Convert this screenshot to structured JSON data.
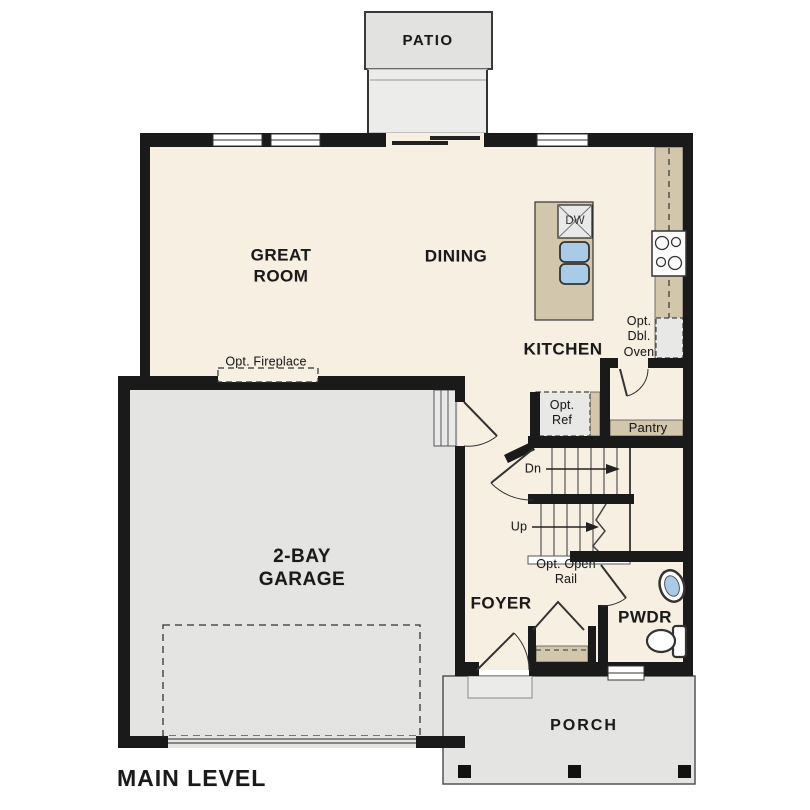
{
  "plan": {
    "title": "MAIN LEVEL",
    "rooms": {
      "patio": "PATIO",
      "great_room": "GREAT\nROOM",
      "dining": "DINING",
      "kitchen": "KITCHEN",
      "garage": "2-BAY\nGARAGE",
      "foyer": "FOYER",
      "powder": "PWDR",
      "porch": "PORCH"
    },
    "annotations": {
      "opt_fireplace": "Opt. Fireplace",
      "opt_ref": "Opt.\nRef",
      "opt_dbl_oven": "Opt.\nDbl.\nOven",
      "pantry": "Pantry",
      "stairs_down": "Dn",
      "stairs_up": "Up",
      "opt_open_rail": "Opt. Open\nRail",
      "dishwasher": "DW"
    },
    "fixtures": [
      "dishwasher",
      "kitchen-sink",
      "range",
      "double-oven-option",
      "refrigerator-option",
      "bathroom-sink",
      "toilet",
      "stairs",
      "coat-closet"
    ],
    "colors": {
      "wall": "#1a1a1a",
      "interior_floor": "#f8efe3",
      "concrete": "#e4e4e2",
      "landing": "#ececea",
      "casework": "#d2c6ac",
      "option_fill": "#e8e8e6",
      "fixture_water": "#aacbe8",
      "line": "#333333"
    }
  }
}
